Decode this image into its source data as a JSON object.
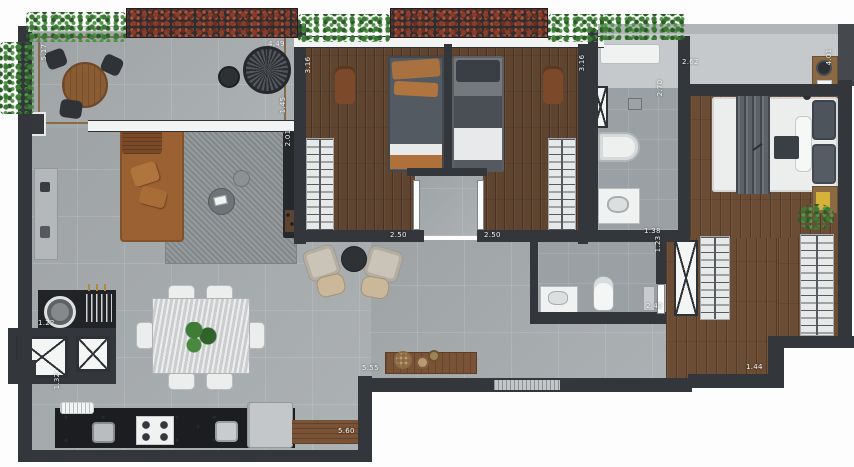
{
  "plan_title": "apartment-floor-plan",
  "dimensions": {
    "balcony_depth": "5.17",
    "balcony_width": "4.49",
    "bedroom1_depth": "3.16",
    "bedroom1_width": "2.50",
    "bedroom2_depth": "3.16",
    "bedroom2_width": "2.50",
    "living_opening": "1.45",
    "living_media": "2.01",
    "bath1_depth": "2.70",
    "bath1_width": "1.38",
    "master_width": "2.62",
    "master_depth": "4.01",
    "bath2_depth": "1.23",
    "bath2_width": "2.42",
    "living_span": "5.55",
    "kitchen_span": "5.60",
    "service_width": "1.22",
    "entry_width": "1.32",
    "closet_width": "1.44"
  },
  "palette": {
    "wall": "#33363a",
    "social_floor": "#a8adb0",
    "bath_floor": "#9aa0a4",
    "wood_floor": "#5f4430",
    "master_wood_floor": "#6b4c34",
    "kitchen_counter": "#1b1d20",
    "sofa": "#9c6132",
    "rug": "#8d9396",
    "plants": "#3c7a36",
    "red_plants": "#8a3c28",
    "marble_table": "#d9dbdc",
    "label_text": "#f4f4f4",
    "accent_yellow": "#d7b23a"
  }
}
